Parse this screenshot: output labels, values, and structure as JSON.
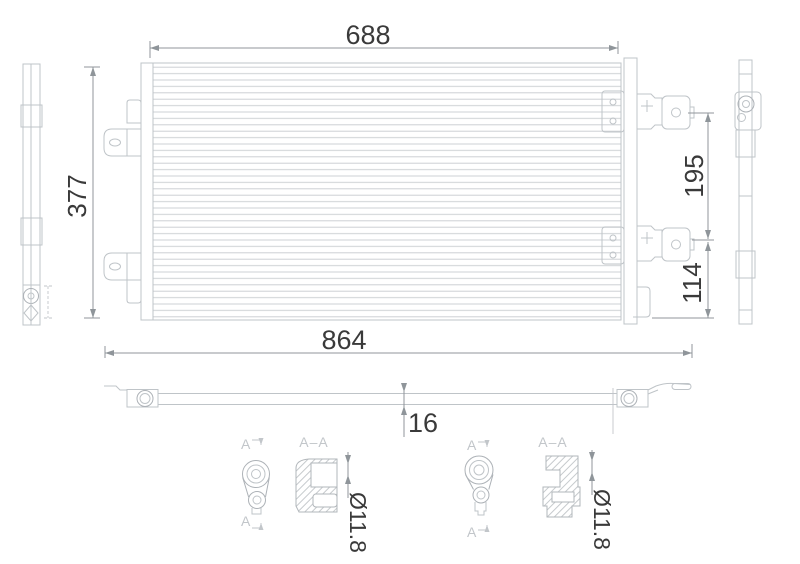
{
  "dimensions": {
    "core_width": "688",
    "core_height": "377",
    "overall_length": "864",
    "upper_mount_spacing": "195",
    "lower_mount_offset": "114",
    "tube_depth": "16",
    "port_diameter_left": "Ø11.8",
    "port_diameter_right": "Ø11.8"
  },
  "section_labels": {
    "left": {
      "top": "A",
      "bottom": "A",
      "title": "A–A"
    },
    "right": {
      "top": "A",
      "bottom": "A",
      "title": "A–A"
    }
  },
  "colors": {
    "background": "#ffffff",
    "geometry_line": "#bfc4c8",
    "dimension_line": "#90969b",
    "dimension_text": "#3a3a3a",
    "label_text": "#c2c6ca"
  }
}
